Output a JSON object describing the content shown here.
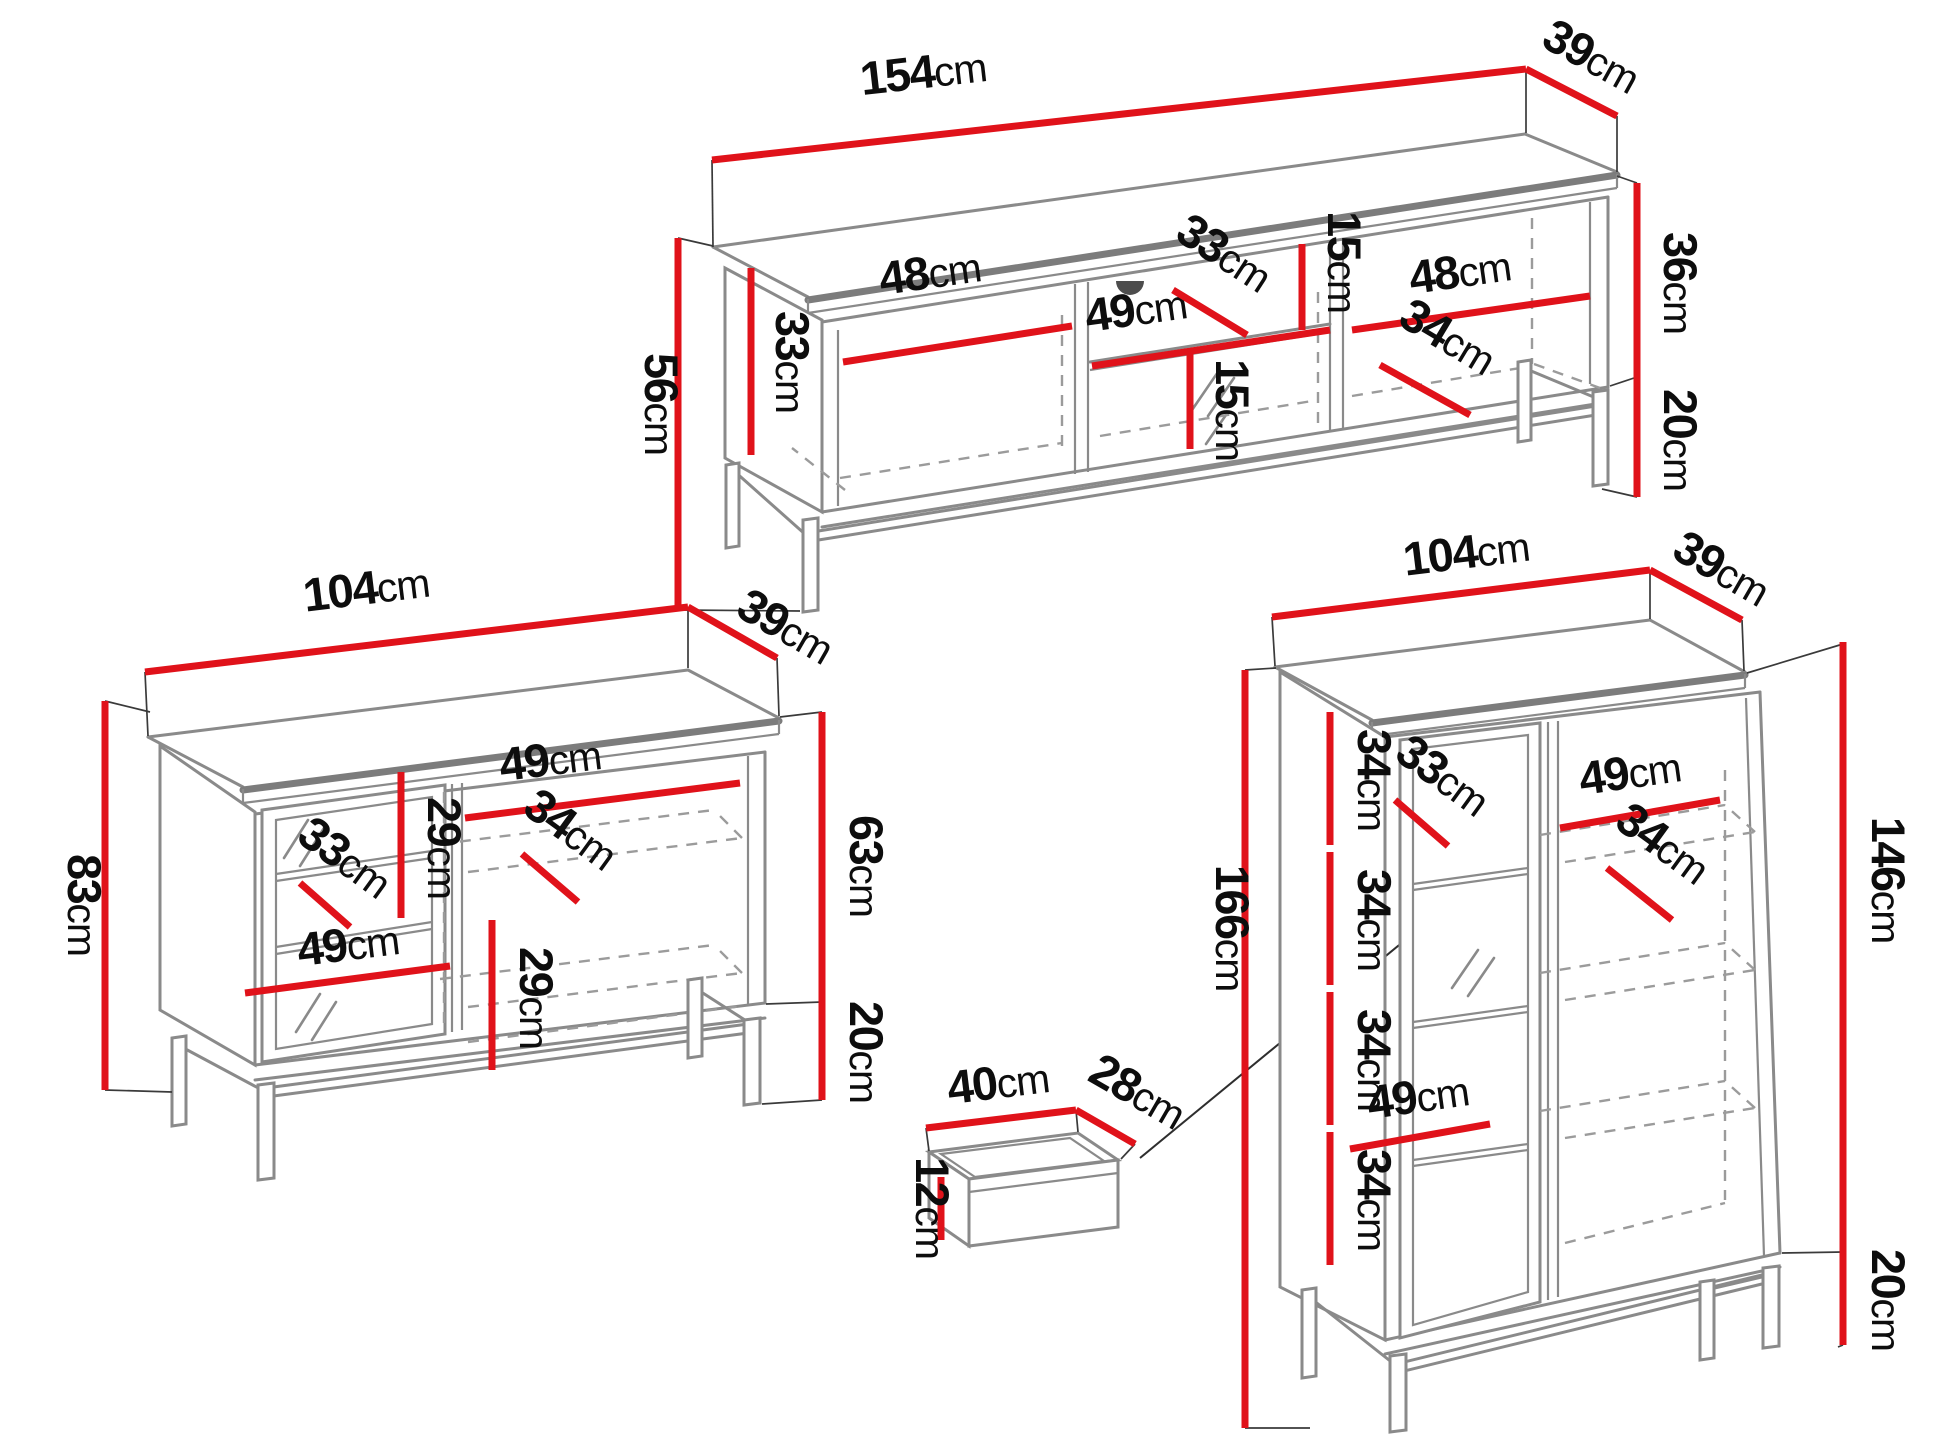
{
  "colors": {
    "dimension_red": "#e0121a",
    "furniture_edge_gray": "#8a8a8a",
    "text_black": "#0d0d0d",
    "background": "#ffffff"
  },
  "labels": {
    "tv_width": {
      "value": "154",
      "unit": "cm"
    },
    "tv_depth": {
      "value": "39",
      "unit": "cm"
    },
    "tv_total_height": {
      "value": "56",
      "unit": "cm"
    },
    "tv_side_inner_height": {
      "value": "33",
      "unit": "cm"
    },
    "tv_left_compartment_width": {
      "value": "48",
      "unit": "cm"
    },
    "tv_middle_compartment_width": {
      "value": "49",
      "unit": "cm"
    },
    "tv_middle_shelf_depth": {
      "value": "33",
      "unit": "cm"
    },
    "tv_top_niche_height": {
      "value": "15",
      "unit": "cm"
    },
    "tv_bottom_niche_height": {
      "value": "15",
      "unit": "cm"
    },
    "tv_right_compartment_width": {
      "value": "48",
      "unit": "cm"
    },
    "tv_right_shelf_depth": {
      "value": "34",
      "unit": "cm"
    },
    "tv_body_height": {
      "value": "36",
      "unit": "cm"
    },
    "tv_leg_height": {
      "value": "20",
      "unit": "cm"
    },
    "sb_width": {
      "value": "104",
      "unit": "cm"
    },
    "sb_depth": {
      "value": "39",
      "unit": "cm"
    },
    "sb_total_height": {
      "value": "83",
      "unit": "cm"
    },
    "sb_top_gap_height": {
      "value": "29",
      "unit": "cm"
    },
    "sb_right_shelf_width": {
      "value": "49",
      "unit": "cm"
    },
    "sb_glass_shelf_depth": {
      "value": "33",
      "unit": "cm"
    },
    "sb_right_shelf_depth": {
      "value": "34",
      "unit": "cm"
    },
    "sb_door_shelf_width": {
      "value": "49",
      "unit": "cm"
    },
    "sb_bottom_gap_height": {
      "value": "29",
      "unit": "cm"
    },
    "sb_body_height": {
      "value": "63",
      "unit": "cm"
    },
    "sb_leg_height": {
      "value": "20",
      "unit": "cm"
    },
    "dr_width": {
      "value": "40",
      "unit": "cm"
    },
    "dr_depth": {
      "value": "28",
      "unit": "cm"
    },
    "dr_height": {
      "value": "12",
      "unit": "cm"
    },
    "vt_width": {
      "value": "104",
      "unit": "cm"
    },
    "vt_depth": {
      "value": "39",
      "unit": "cm"
    },
    "vt_total_height": {
      "value": "166",
      "unit": "cm"
    },
    "vt_gap1_height": {
      "value": "34",
      "unit": "cm"
    },
    "vt_gap2_height": {
      "value": "34",
      "unit": "cm"
    },
    "vt_gap3_height": {
      "value": "34",
      "unit": "cm"
    },
    "vt_gap4_height": {
      "value": "34",
      "unit": "cm"
    },
    "vt_glass_shelf_depth": {
      "value": "33",
      "unit": "cm"
    },
    "vt_top_shelf_width": {
      "value": "49",
      "unit": "cm"
    },
    "vt_shelf_depth": {
      "value": "34",
      "unit": "cm"
    },
    "vt_bottom_shelf_width": {
      "value": "49",
      "unit": "cm"
    },
    "vt_body_height": {
      "value": "146",
      "unit": "cm"
    },
    "vt_leg_height": {
      "value": "20",
      "unit": "cm"
    }
  }
}
